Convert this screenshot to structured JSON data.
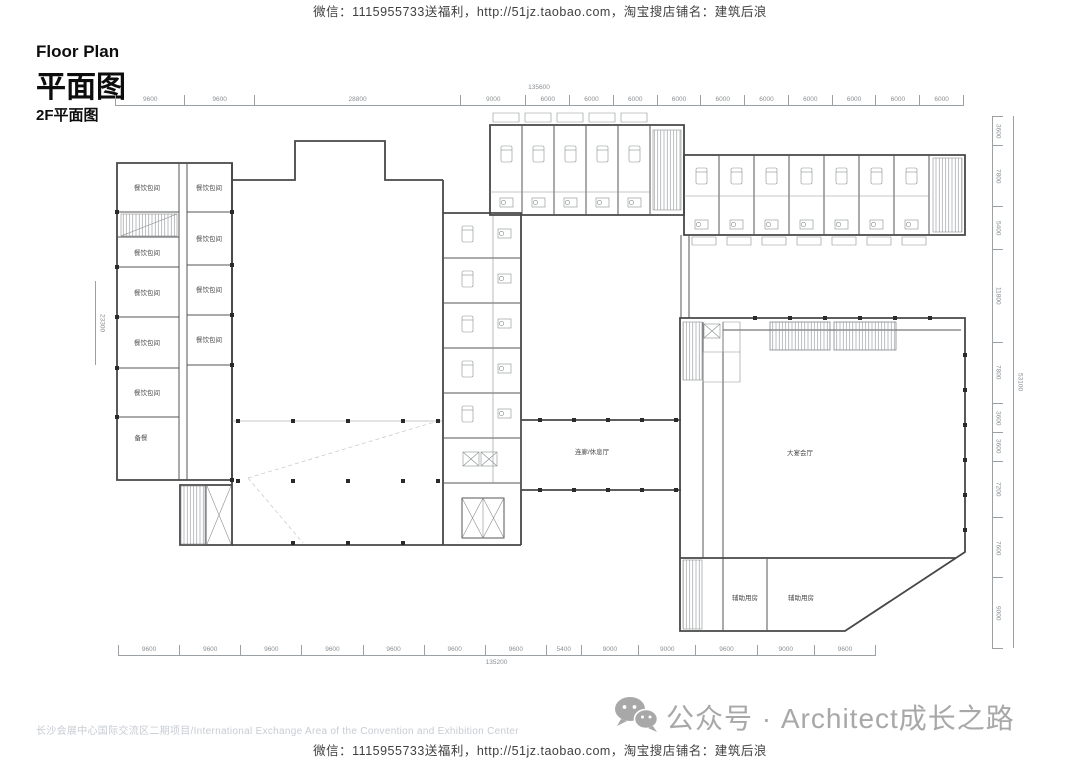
{
  "watermark": {
    "top": "微信：1115955733送福利，http://51jz.taobao.com，淘宝搜店铺名：建筑后浪",
    "bottom": "微信：1115955733送福利，http://51jz.taobao.com，淘宝搜店铺名：建筑后浪"
  },
  "title": {
    "en": "Floor Plan",
    "zh": "平面图",
    "floor_label": "2F平面图"
  },
  "plan": {
    "rooms": {
      "dining_l1": "餐饮包间",
      "dining_l2": "餐饮包间",
      "dining_l3": "餐饮包间",
      "dining_l4": "餐饮包间",
      "dining_l5": "餐饮包间",
      "dining_r1": "餐饮包间",
      "dining_r2": "餐饮包间",
      "dining_r3": "餐饮包间",
      "dining_r4": "餐饮包间",
      "prep": "备餐",
      "ballroom": "大宴会厅",
      "lounge": "连廊/休息厅",
      "aux_1": "辅助用房",
      "aux_2": "辅助用房"
    },
    "dims": {
      "top": [
        "9600",
        "9600",
        "28800",
        "9000",
        "6000",
        "6000",
        "6000",
        "6000",
        "6000",
        "6000",
        "6000",
        "6000",
        "6000",
        "6000"
      ],
      "top_total": "135600",
      "bottom": [
        "9600",
        "9600",
        "9600",
        "9600",
        "9600",
        "9600",
        "9600",
        "5400",
        "9000",
        "9000",
        "9600",
        "9000",
        "9600"
      ],
      "bottom_total": "135200",
      "right": [
        "3600",
        "7800",
        "5400",
        "11800",
        "7800",
        "3600",
        "3600",
        "7200",
        "7600",
        "9000"
      ],
      "right_total": "53100",
      "left": "23300"
    }
  },
  "footer": {
    "project": "长沙会展中心国际交流区二期项目/International Exchange Area of the Convention and Exhibition Center",
    "wechat_account": "公众号 · Architect成长之路"
  }
}
